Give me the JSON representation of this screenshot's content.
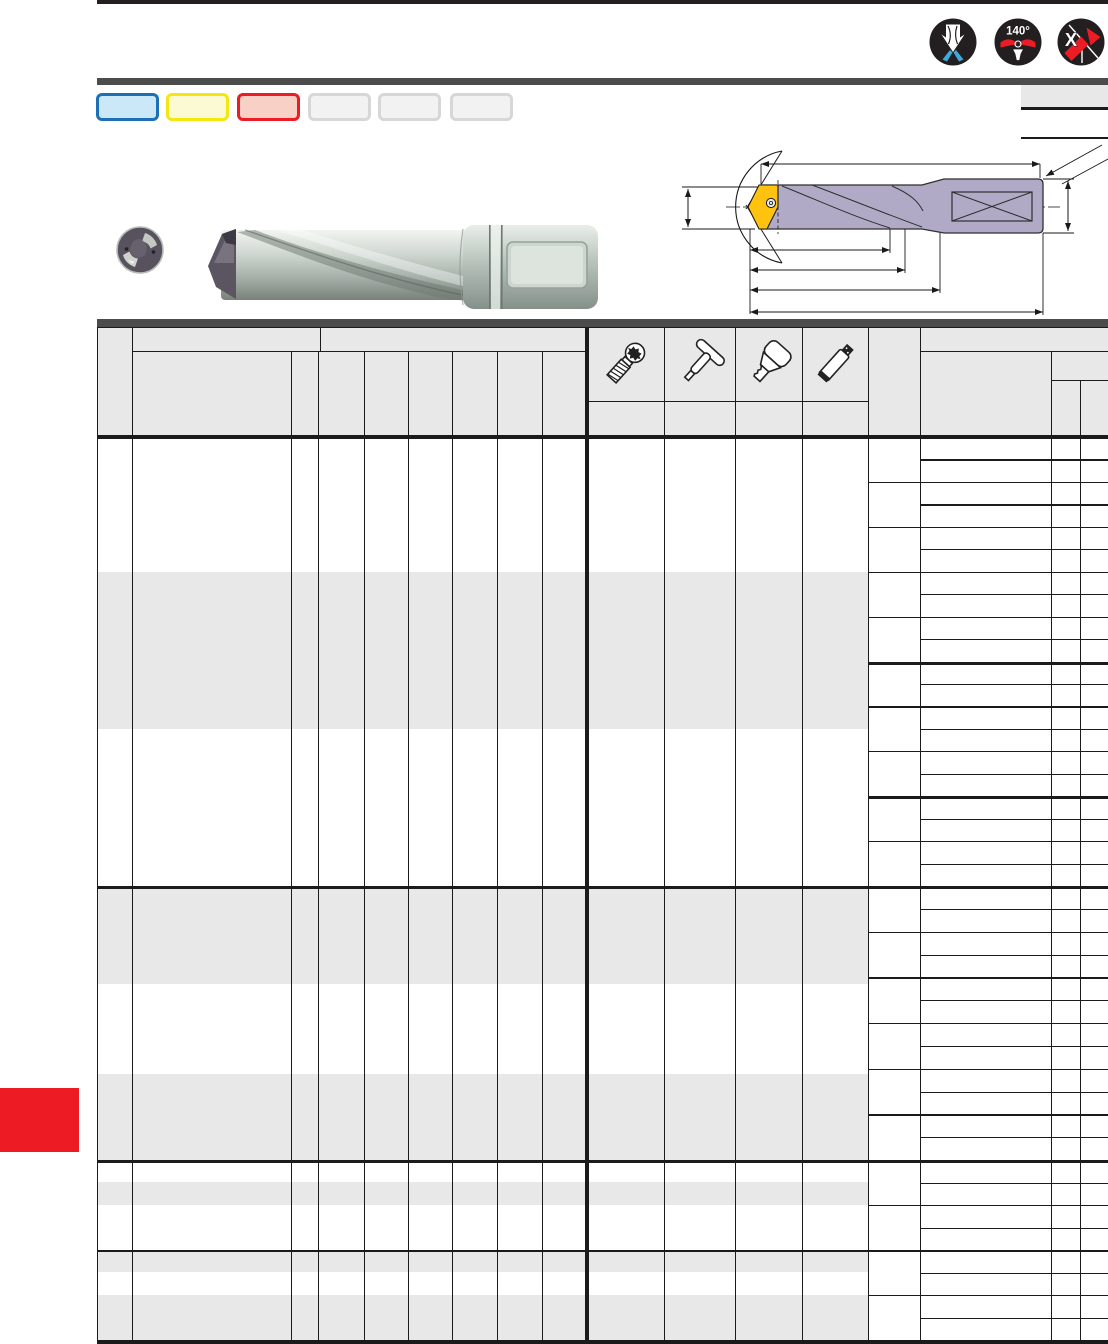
{
  "page": {
    "kind": "tool-catalog-page",
    "top_bar_color": "#231f20",
    "section_bar_color": "#4c4c4c",
    "red_tab_color": "#ed1c24"
  },
  "top_badges": [
    {
      "name": "internal-coolant-icon",
      "label": ""
    },
    {
      "name": "point-angle-icon",
      "label": "140°"
    },
    {
      "name": "x-geometry-icon",
      "label": "X"
    }
  ],
  "legend": {
    "chips": [
      {
        "id": "blue",
        "fill": "#cbe8f9",
        "border": "#1d70b8"
      },
      {
        "id": "yellow",
        "fill": "#fcfad2",
        "border": "#f3e70f"
      },
      {
        "id": "red",
        "fill": "#f8d0c6",
        "border": "#ec1c24"
      },
      {
        "id": "gray-1",
        "fill": "#f2f2f2",
        "border": "#d7d7d7"
      },
      {
        "id": "gray-2",
        "fill": "#f2f2f2",
        "border": "#d7d7d7"
      },
      {
        "id": "gray-3",
        "fill": "#f2f2f2",
        "border": "#d7d7d7"
      }
    ]
  },
  "header_icons": [
    {
      "name": "clamping-screw-icon"
    },
    {
      "name": "torx-key-icon"
    },
    {
      "name": "insert-key-icon"
    },
    {
      "name": "lubricant-paste-icon"
    }
  ],
  "diagram": {
    "body_color": "#b1aac7",
    "insert_color": "#ffc20e",
    "line_color": "#1a1a1a"
  },
  "accents": {
    "coolant_blue": "#3fa9dc",
    "signal_red": "#ed1c24"
  },
  "table": {
    "grid_color": "#1b1b1b",
    "zebra_color": "#e8e8e8",
    "cells_text": ""
  }
}
